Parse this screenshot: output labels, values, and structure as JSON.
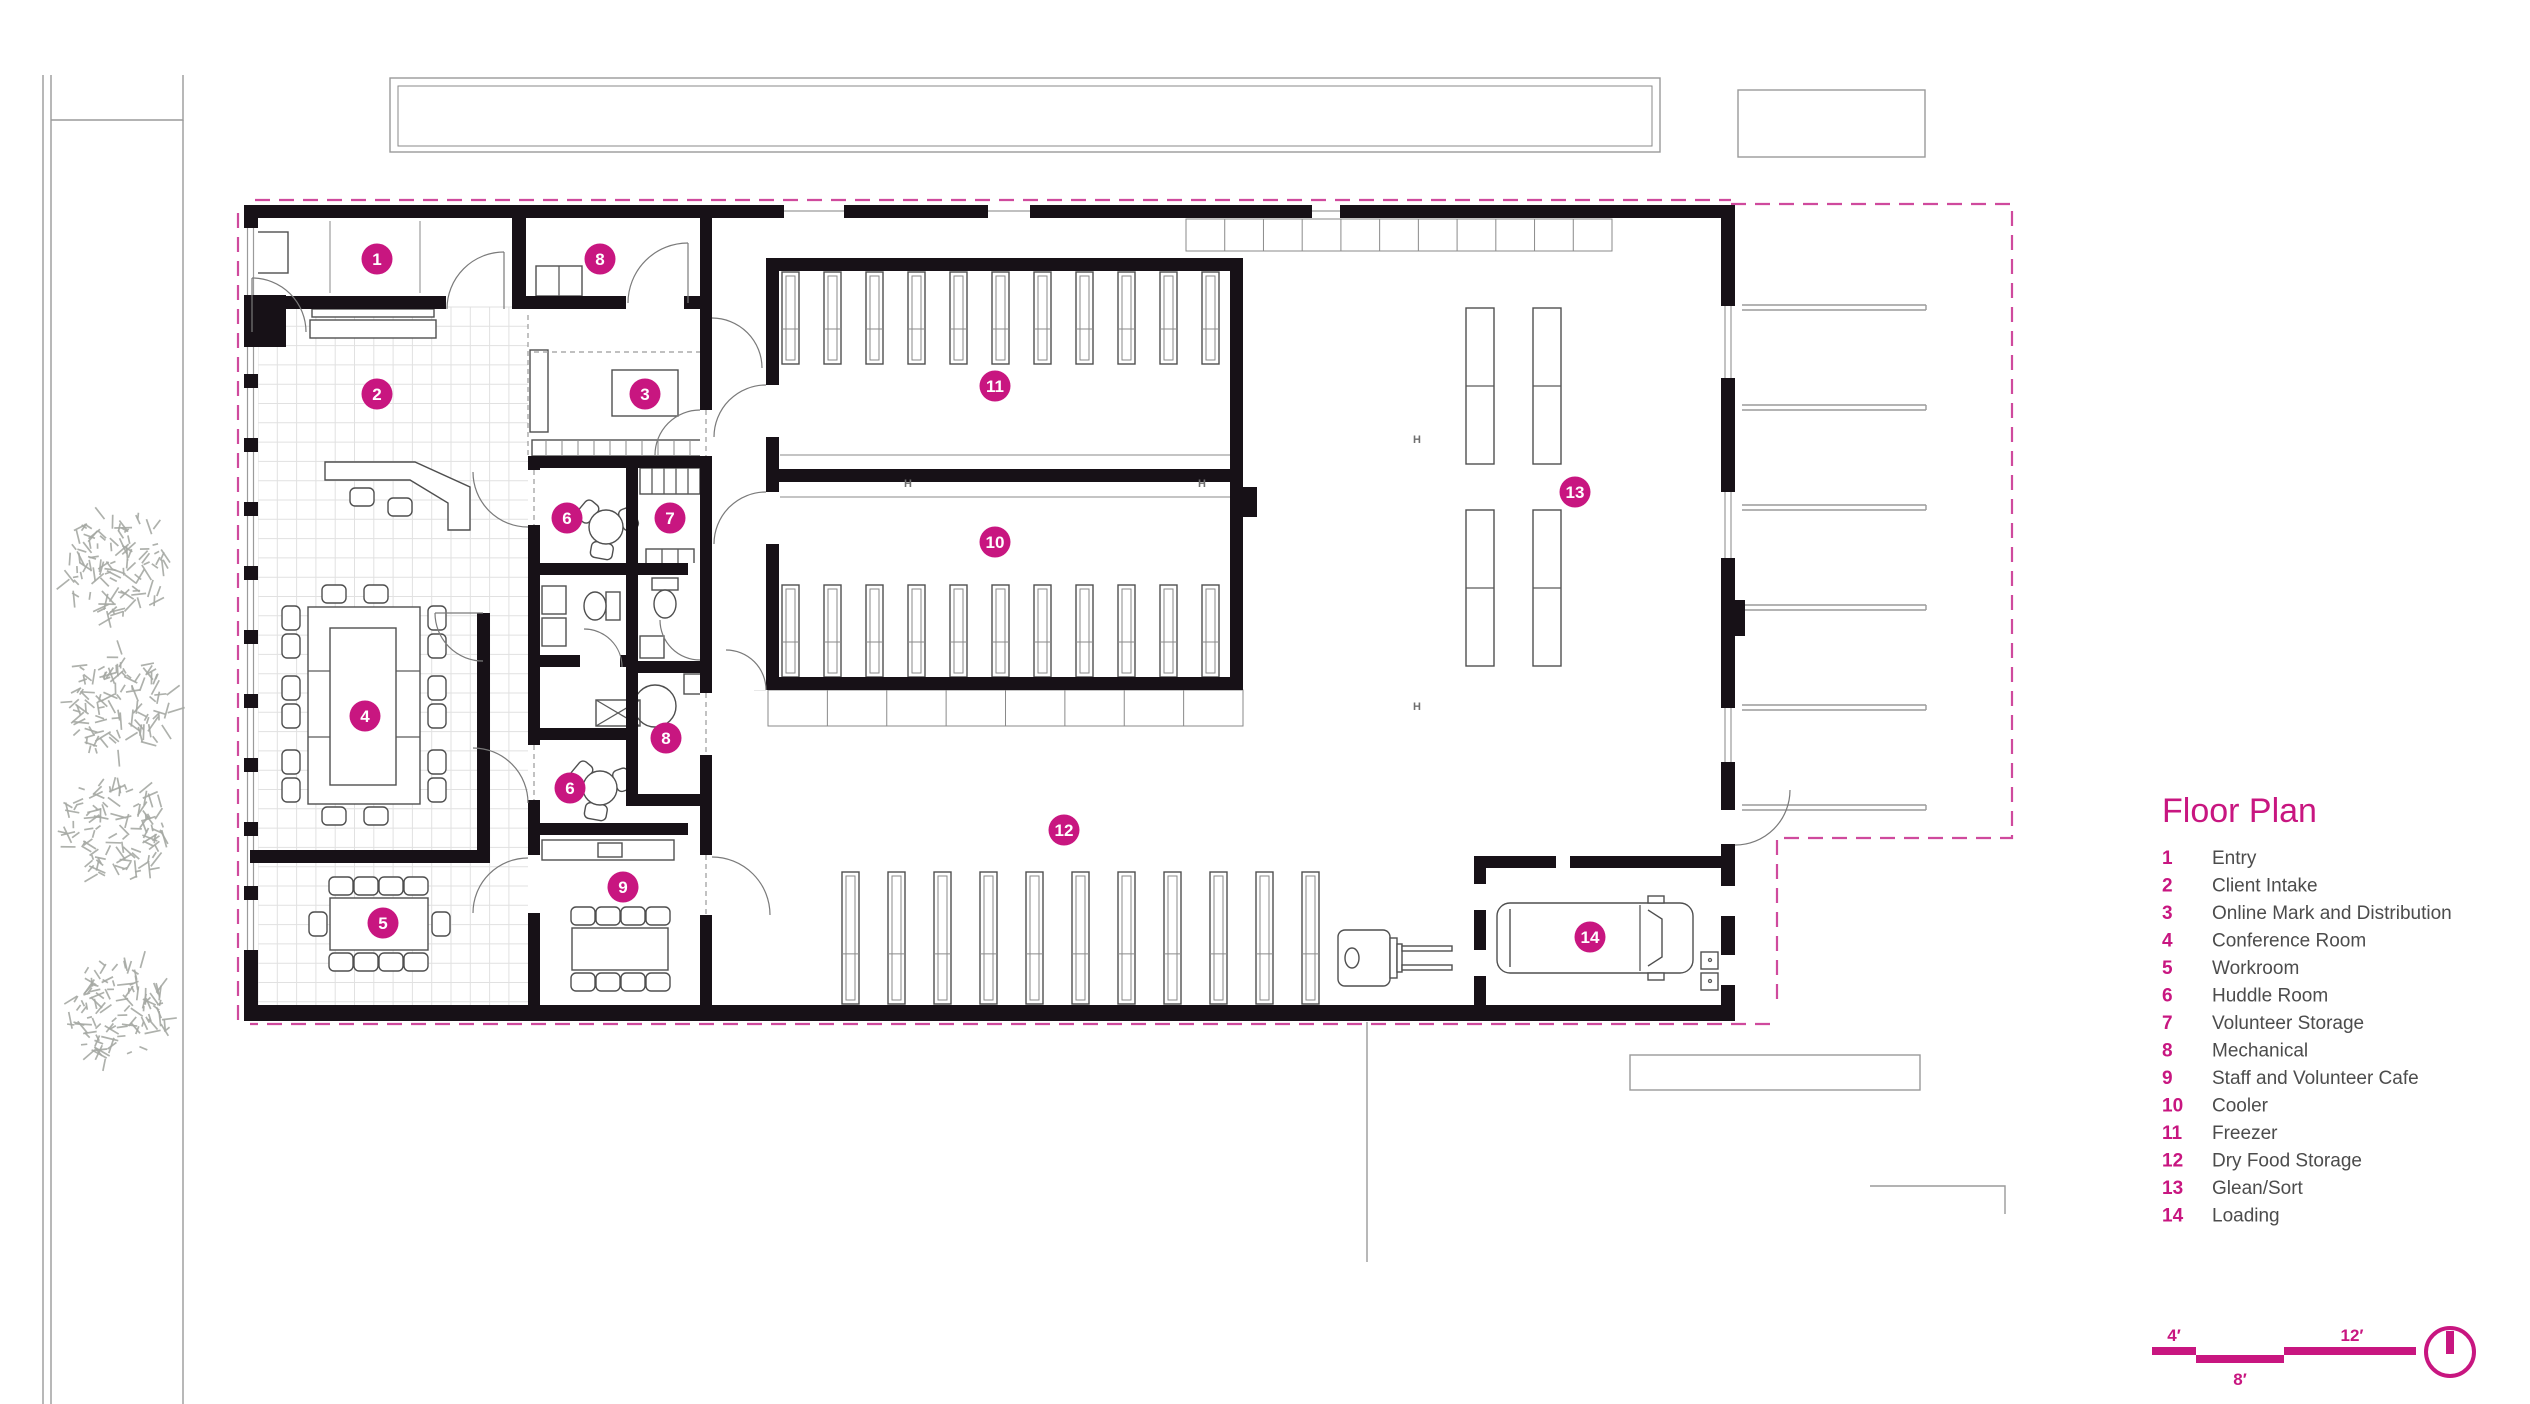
{
  "document_type": "architectural floor plan drawing",
  "legend": {
    "title": "Floor Plan",
    "items": [
      {
        "num": "1",
        "label": "Entry"
      },
      {
        "num": "2",
        "label": "Client Intake"
      },
      {
        "num": "3",
        "label": "Online Mark and Distribution"
      },
      {
        "num": "4",
        "label": "Conference Room"
      },
      {
        "num": "5",
        "label": "Workroom"
      },
      {
        "num": "6",
        "label": "Huddle Room"
      },
      {
        "num": "7",
        "label": "Volunteer Storage"
      },
      {
        "num": "8",
        "label": "Mechanical"
      },
      {
        "num": "9",
        "label": "Staff and Volunteer Cafe"
      },
      {
        "num": "10",
        "label": "Cooler"
      },
      {
        "num": "11",
        "label": "Freezer"
      },
      {
        "num": "12",
        "label": "Dry Food Storage"
      },
      {
        "num": "13",
        "label": "Glean/Sort"
      },
      {
        "num": "14",
        "label": "Loading"
      }
    ]
  },
  "room_markers": [
    {
      "num": "1",
      "x": 377,
      "y": 259
    },
    {
      "num": "8",
      "x": 600,
      "y": 259
    },
    {
      "num": "2",
      "x": 377,
      "y": 394
    },
    {
      "num": "3",
      "x": 645,
      "y": 394
    },
    {
      "num": "6",
      "x": 567,
      "y": 518
    },
    {
      "num": "7",
      "x": 670,
      "y": 518
    },
    {
      "num": "11",
      "x": 995,
      "y": 386
    },
    {
      "num": "10",
      "x": 995,
      "y": 542
    },
    {
      "num": "13",
      "x": 1575,
      "y": 492
    },
    {
      "num": "4",
      "x": 365,
      "y": 716
    },
    {
      "num": "8",
      "x": 666,
      "y": 738
    },
    {
      "num": "6",
      "x": 570,
      "y": 788
    },
    {
      "num": "12",
      "x": 1064,
      "y": 830
    },
    {
      "num": "9",
      "x": 623,
      "y": 887
    },
    {
      "num": "5",
      "x": 383,
      "y": 923
    },
    {
      "num": "14",
      "x": 1590,
      "y": 937
    }
  ],
  "scale_bar": {
    "segment_labels": [
      "4′",
      "8′",
      "12′"
    ]
  },
  "plan_symbols": {
    "column_marker": "H",
    "column_positions": [
      {
        "x": 908,
        "y": 487
      },
      {
        "x": 1202,
        "y": 487
      },
      {
        "x": 1417,
        "y": 443
      },
      {
        "x": 1417,
        "y": 710
      }
    ]
  },
  "colors": {
    "accent": "#c81680",
    "boundary_dash": "#cf4a9d",
    "wall": "#171117"
  }
}
